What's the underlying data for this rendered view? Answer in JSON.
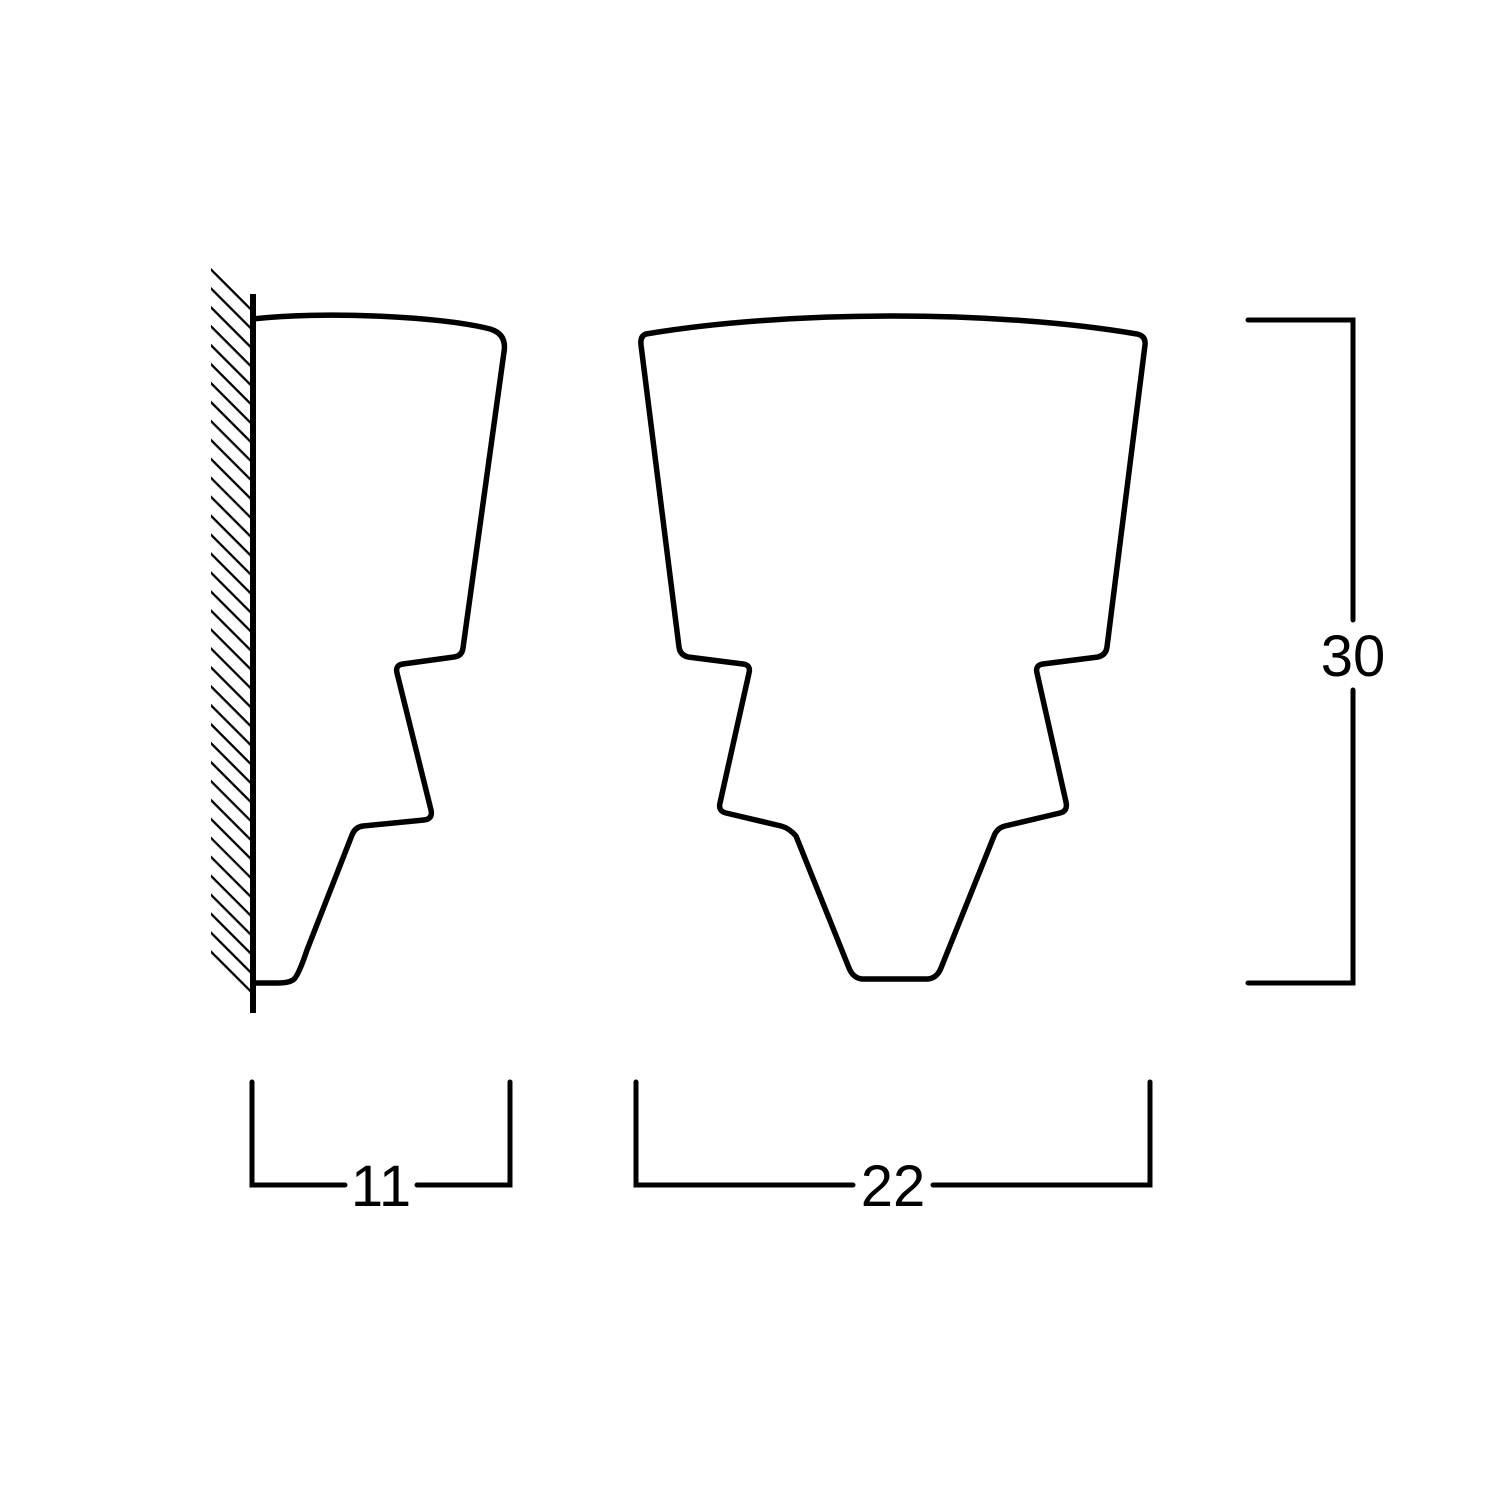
{
  "page": {
    "background_color": "#ffffff",
    "line_color": "#000000"
  },
  "drawing": {
    "type": "technical-dimension-drawing",
    "views": {
      "side_view": {
        "name": "side-profile-against-wall"
      },
      "front_view": {
        "name": "front-profile"
      }
    },
    "dimensions": {
      "depth": {
        "value": "11"
      },
      "width": {
        "value": "22"
      },
      "height": {
        "value": "30"
      }
    }
  }
}
